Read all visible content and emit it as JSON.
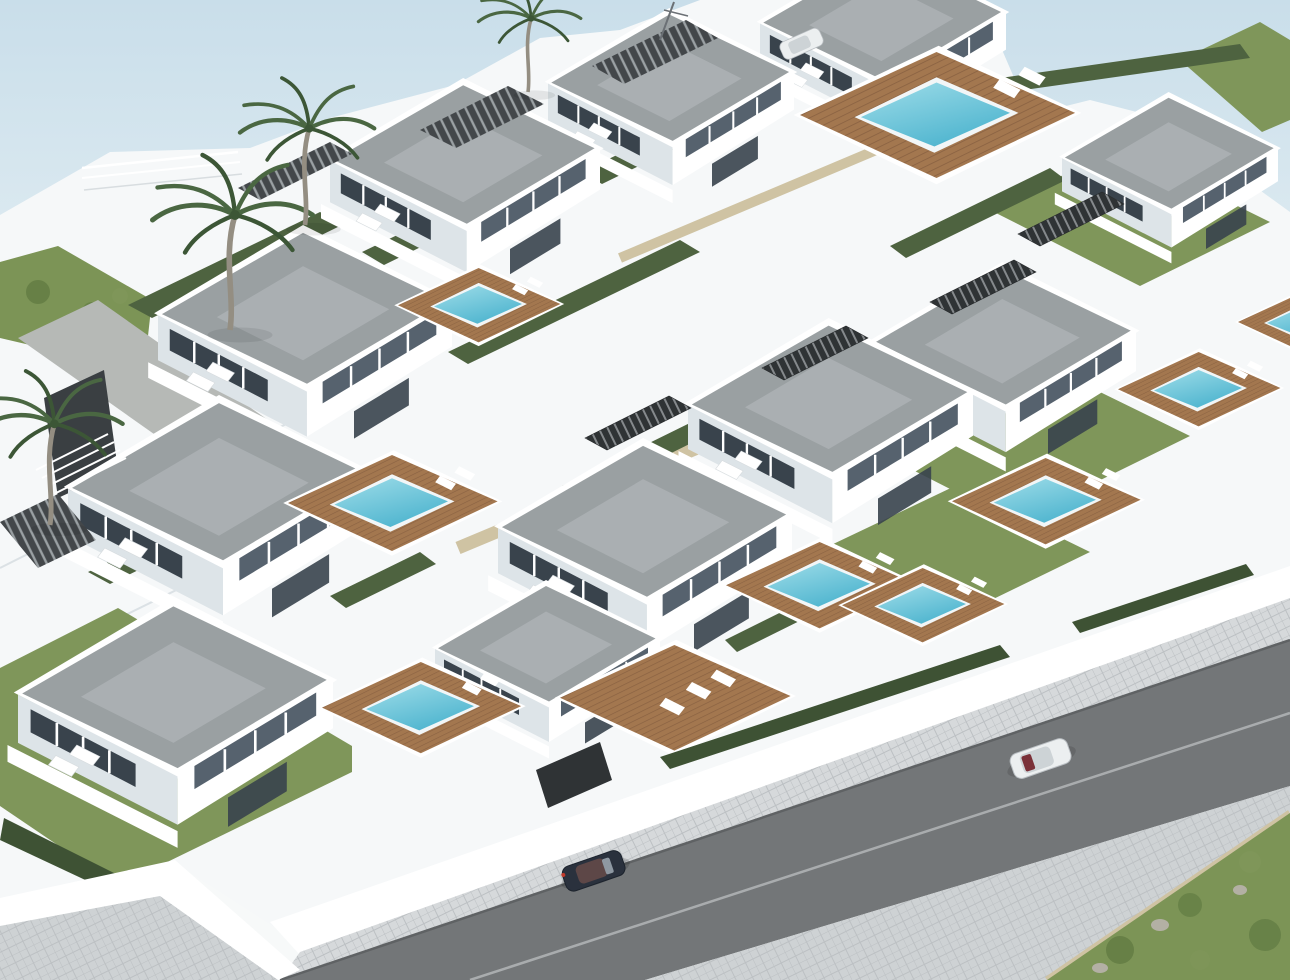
{
  "scene": {
    "title": "Aerial 3D render of a terraced villa development with private pools beside a road",
    "setting": "hillside residential complex of modern white villas",
    "render_style": "architectural CGI, daylight, pale sky",
    "objects": {
      "white_modern_villas": 11,
      "swimming_pools": 9,
      "wooden_pool_decks": 10,
      "green_lawns": 5,
      "hedge_rows": 11,
      "palm_trees": 4,
      "pergolas": 4,
      "outdoor_staircases": 4,
      "cars_driving_on_road": 2,
      "cars_parked": 1,
      "road_lanes": 2,
      "sun_loungers_present": true,
      "scrub_vegetation_corner": true
    }
  },
  "palette": {
    "sky_top": "#c9deea",
    "sky_mid": "#e6f0f4",
    "sky_low": "#f7f9f9",
    "wall": "#f6f8f9",
    "wall_bright": "#ffffff",
    "wall_shade": "#dde4e8",
    "wall_deep": "#c9d2d7",
    "roof": "#9aa0a2",
    "roof_light": "#b9bec1",
    "window": "#56626e",
    "window_dark": "#39434c",
    "lawn": "#7f965a",
    "lawn_dark": "#66824a",
    "hedge": "#4e6340",
    "hedge_dark": "#3e5234",
    "wood": "#a3774f",
    "wood_dark": "#8a6242",
    "pool_light": "#9fdde9",
    "pool_deep": "#4fb5cf",
    "pool_rim": "#f2f6f7",
    "road": "#737678",
    "road_edge": "#5f6264",
    "road_line": "#b7babc",
    "paver": "#ced2d4",
    "paver_line": "#bcc0c3",
    "paver_light": "#d6d9db",
    "curb": "#f0f2f3",
    "stairs": "#2f3335",
    "stairs_light": "#85898c",
    "pergola": "#43474a",
    "pergola_light": "#9aa0a3",
    "trunk": "#948e82",
    "frond": "#4a6742",
    "frond_dark": "#3c5636",
    "scrub": "#7c9456",
    "scrub_dark": "#5e7840",
    "rock": "#b3b0a4",
    "sand": "#cfc3a3",
    "path_gray": "#b6b9b6",
    "wall_wedge": "#3a3f42",
    "car_dark": "#2a313d",
    "car_cabin": "#5d4747",
    "car_white": "#eceff0",
    "car_glass": "#cdd3d6",
    "tail_red": "#7a3038"
  }
}
